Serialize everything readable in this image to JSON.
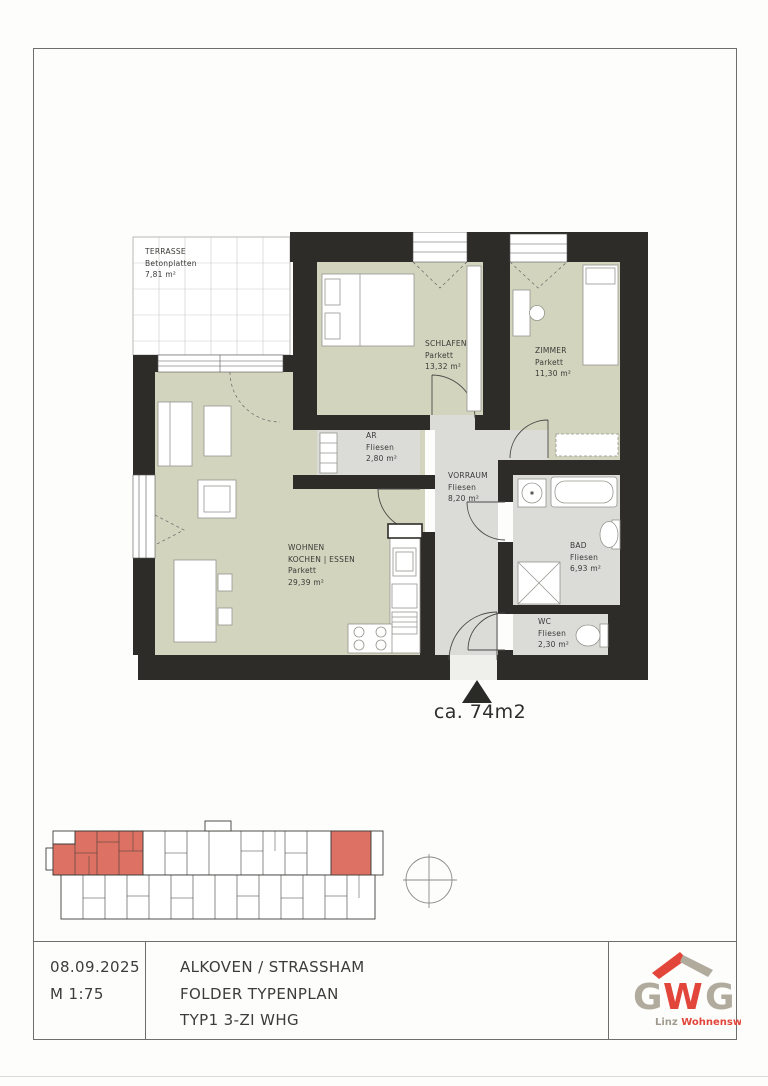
{
  "floorplan": {
    "rooms": [
      {
        "name": "TERRASSE",
        "floor": "Betonplatten",
        "area": "7,81 m²"
      },
      {
        "name": "SCHLAFEN",
        "floor": "Parkett",
        "area": "13,32 m²"
      },
      {
        "name": "ZIMMER",
        "floor": "Parkett",
        "area": "11,30 m²"
      },
      {
        "name": "AR",
        "floor": "Fliesen",
        "area": "2,80 m²"
      },
      {
        "name": "VORRAUM",
        "floor": "Fliesen",
        "area": "8,20 m²"
      },
      {
        "name": "WOHNEN",
        "name_line2": "KOCHEN | ESSEN",
        "floor": "Parkett",
        "area": "29,39 m²"
      },
      {
        "name": "BAD",
        "floor": "Fliesen",
        "area": "6,93 m²"
      },
      {
        "name": "WC",
        "floor": "Fliesen",
        "area": "2,30 m²"
      }
    ],
    "total_area_label": "ca. 74m2"
  },
  "title_block": {
    "date": "08.09.2025",
    "scale": "M 1:75",
    "line1": "ALKOVEN / STRASSHAM",
    "line2": "FOLDER TYPENPLAN",
    "line3": "TYP1 3-ZI WHG"
  },
  "logo": {
    "g1": "G",
    "w": "W",
    "g2": "G",
    "tagline_gray": "Linz ",
    "tagline_red": "Wohnenswert."
  },
  "colors": {
    "wall": "#2e2c28",
    "parkett_green": "#d3d4bd",
    "fliesen_gray": "#dbdbd8",
    "overview_highlight": "#dd7163",
    "logo_red": "#e2453a",
    "logo_gray": "#b1ab9e"
  }
}
